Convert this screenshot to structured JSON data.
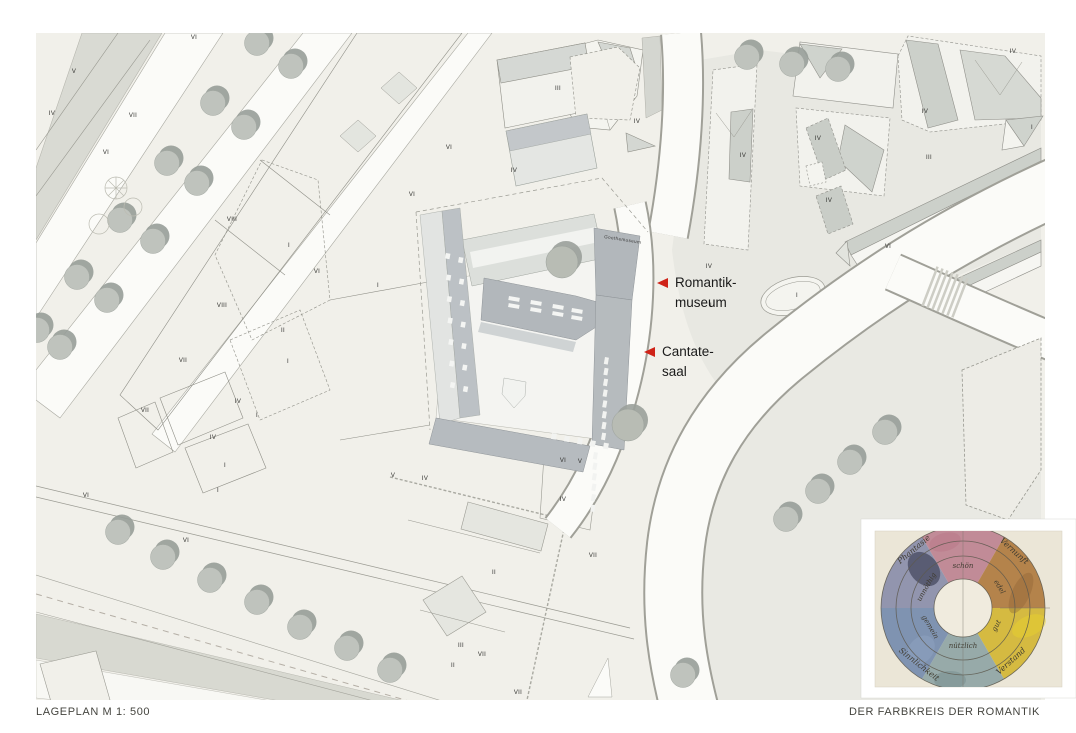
{
  "footer": {
    "left": "LAGEPLAN M 1: 500",
    "right": "DER FARBKREIS DER ROMANTIK"
  },
  "plan": {
    "street_building_label": "Goethemuseum",
    "arrow_color": "#cf2318",
    "annotations": [
      {
        "id": "romantikmuseum",
        "lines": [
          "Romantik-",
          "museum"
        ],
        "x": 675,
        "y": 287,
        "ax": 668,
        "ay": 283
      },
      {
        "id": "cantatesaal",
        "lines": [
          "Cantate-",
          "saal"
        ],
        "x": 662,
        "y": 356,
        "ax": 655,
        "ay": 352
      }
    ],
    "storey_labels": [
      {
        "t": "VI",
        "x": 194,
        "y": 39
      },
      {
        "t": "V",
        "x": 74,
        "y": 73
      },
      {
        "t": "IV",
        "x": 52,
        "y": 115
      },
      {
        "t": "VII",
        "x": 133,
        "y": 117
      },
      {
        "t": "VI",
        "x": 106,
        "y": 154
      },
      {
        "t": "VIII",
        "x": 232,
        "y": 221
      },
      {
        "t": "I",
        "x": 289,
        "y": 247
      },
      {
        "t": "VI",
        "x": 317,
        "y": 273
      },
      {
        "t": "VIII",
        "x": 222,
        "y": 307
      },
      {
        "t": "II",
        "x": 283,
        "y": 332
      },
      {
        "t": "I",
        "x": 288,
        "y": 363
      },
      {
        "t": "VI",
        "x": 449,
        "y": 149
      },
      {
        "t": "VI",
        "x": 412,
        "y": 196
      },
      {
        "t": "IV",
        "x": 514,
        "y": 172
      },
      {
        "t": "III",
        "x": 558,
        "y": 90
      },
      {
        "t": "IV",
        "x": 637,
        "y": 123
      },
      {
        "t": "IV",
        "x": 1013,
        "y": 53
      },
      {
        "t": "IV",
        "x": 925,
        "y": 113
      },
      {
        "t": "III",
        "x": 929,
        "y": 159
      },
      {
        "t": "I",
        "x": 1032,
        "y": 129
      },
      {
        "t": "IV",
        "x": 743,
        "y": 157
      },
      {
        "t": "IV",
        "x": 818,
        "y": 140
      },
      {
        "t": "IV",
        "x": 829,
        "y": 202
      },
      {
        "t": "VI",
        "x": 888,
        "y": 248
      },
      {
        "t": "I",
        "x": 797,
        "y": 297
      },
      {
        "t": "IV",
        "x": 709,
        "y": 268
      },
      {
        "t": "I",
        "x": 711,
        "y": 307
      },
      {
        "t": "I",
        "x": 378,
        "y": 287
      },
      {
        "t": "VII",
        "x": 183,
        "y": 362
      },
      {
        "t": "VII",
        "x": 145,
        "y": 412
      },
      {
        "t": "IV",
        "x": 238,
        "y": 403
      },
      {
        "t": "IV",
        "x": 213,
        "y": 439
      },
      {
        "t": "I",
        "x": 257,
        "y": 417
      },
      {
        "t": "VI",
        "x": 86,
        "y": 497
      },
      {
        "t": "VI",
        "x": 186,
        "y": 542
      },
      {
        "t": "V",
        "x": 393,
        "y": 477
      },
      {
        "t": "I",
        "x": 225,
        "y": 467
      },
      {
        "t": "I",
        "x": 218,
        "y": 492
      },
      {
        "t": "IV",
        "x": 425,
        "y": 480
      },
      {
        "t": "VI",
        "x": 563,
        "y": 462
      },
      {
        "t": "V",
        "x": 580,
        "y": 463
      },
      {
        "t": "IV",
        "x": 563,
        "y": 501
      },
      {
        "t": "VII",
        "x": 593,
        "y": 557
      },
      {
        "t": "II",
        "x": 494,
        "y": 574
      },
      {
        "t": "III",
        "x": 461,
        "y": 647
      },
      {
        "t": "VII",
        "x": 482,
        "y": 656
      },
      {
        "t": "II",
        "x": 453,
        "y": 667
      },
      {
        "t": "VII",
        "x": 518,
        "y": 694
      }
    ]
  },
  "color_wheel": {
    "sector_colors": [
      "#c18b97",
      "#b4834b",
      "#d5ba41",
      "#97aaa9",
      "#7f93b1",
      "#9295ae"
    ],
    "inner_labels": [
      {
        "text": "schön",
        "angle": 0
      },
      {
        "text": "edel",
        "angle": 60
      },
      {
        "text": "gut",
        "angle": 118
      },
      {
        "text": "nützlich",
        "angle": 180
      },
      {
        "text": "gemein",
        "angle": 240
      },
      {
        "text": "unnöthig",
        "angle": 300
      }
    ],
    "outer_labels": [
      {
        "text": "Vernunft",
        "angle": 42
      },
      {
        "text": "Verstand",
        "angle": 138
      },
      {
        "text": "Sinnlichkeit",
        "angle": 218
      },
      {
        "text": "Phantasie",
        "angle": 320
      }
    ]
  }
}
